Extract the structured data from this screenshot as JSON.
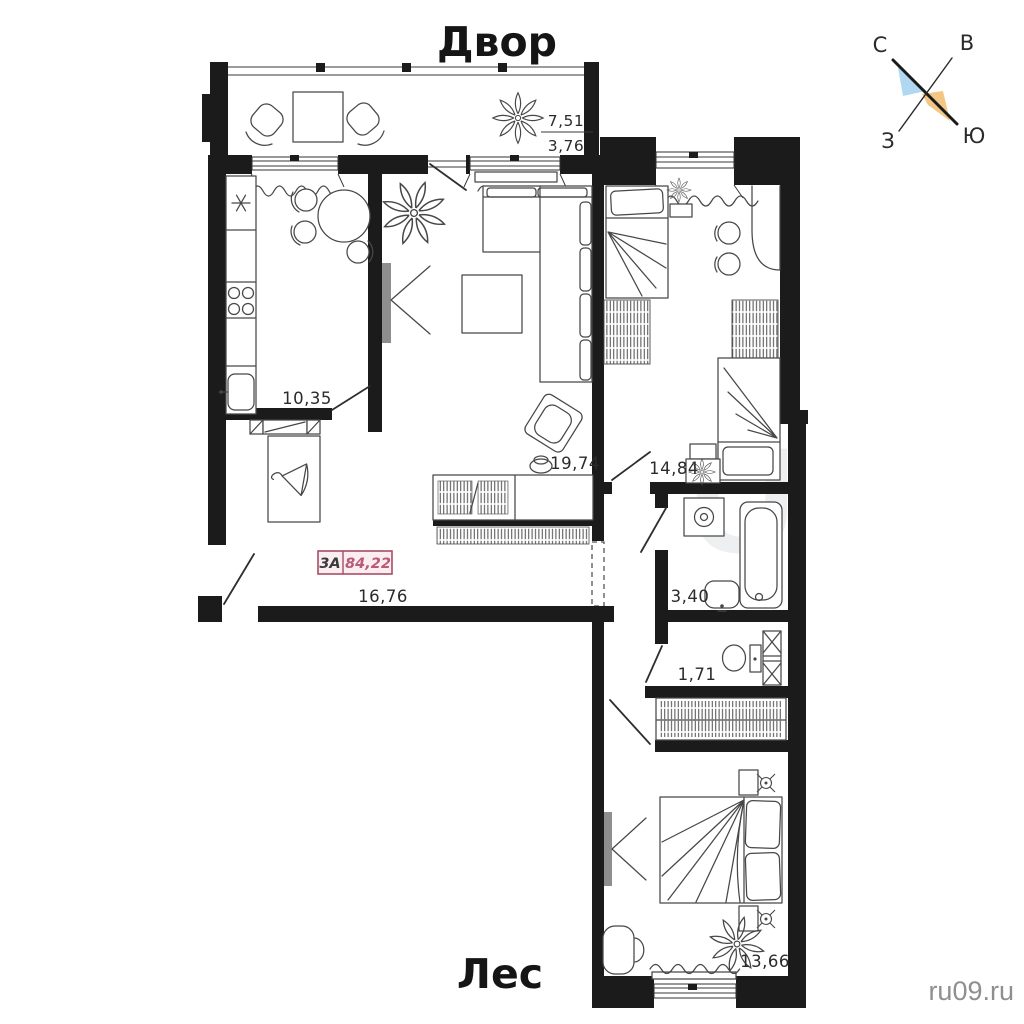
{
  "titles": {
    "top": "Двор",
    "bottom": "Лес"
  },
  "compass": {
    "north": "С",
    "east": "В",
    "west": "З",
    "south": "Ю",
    "accent_blue": "#a9d4f0",
    "accent_orange": "#f2c175"
  },
  "unit_badge": {
    "unit_type": "3А",
    "total_area": "84,22",
    "fill": "#fbeef3",
    "border": "#a84d63",
    "area_text_color": "#bb5a74"
  },
  "areas": {
    "balcony_total": "7,51",
    "balcony_reduced": "3,76",
    "kitchen": "10,35",
    "living_room": "19,74",
    "hallway": "16,76",
    "bedroom_child": "14,84",
    "bathroom": "3,40",
    "wc": "1,71",
    "bedroom_master": "13,66"
  },
  "watermark": {
    "site": "ru09.ru",
    "ghost_letter": "U",
    "color": "#8f8f8f"
  }
}
